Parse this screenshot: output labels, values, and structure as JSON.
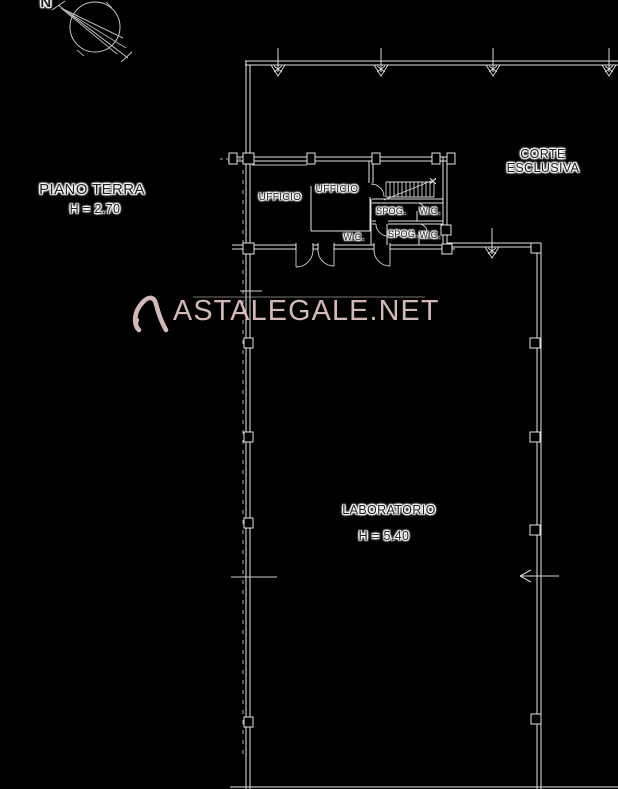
{
  "compass": {
    "north_label": "N"
  },
  "floor": {
    "name": "PIANO TERRA",
    "height": "H = 2.70"
  },
  "courtyard": {
    "line1": "CORTE",
    "line2": "ESCLUSIVA"
  },
  "rooms": {
    "office_left": "UFFICIO",
    "office_center": "UFFICIO",
    "wc_center": "W.C.",
    "spog_1": "SPOG.",
    "wc_1": "W.C.",
    "spog_2": "SPOG.",
    "wc_2": "W.C.",
    "laboratory": "LABORATORIO",
    "laboratory_height": "H = 5.40"
  },
  "watermark": {
    "text": "ASTALEGALE.NET"
  },
  "colors": {
    "background": "#000000",
    "line": "#e4e4e4",
    "dim_line": "#9a9a9a",
    "watermark": "#e4c6c6",
    "label_text": "#1f1f1f",
    "label_halo": "#ffffff"
  }
}
